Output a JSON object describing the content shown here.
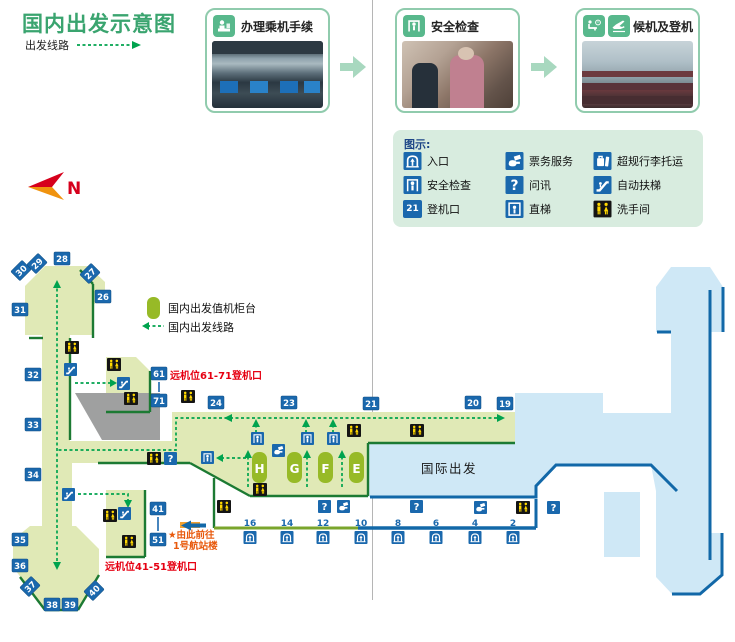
{
  "page": {
    "title": "国内出发示意图",
    "route_label": "出发线路"
  },
  "process_steps": [
    {
      "label": "办理乘机手续",
      "icon": "checkin-counter-icon"
    },
    {
      "label": "安全检查",
      "icon": "security-gate-icon"
    },
    {
      "label": "候机及登机",
      "icon": "waiting-and-plane-icon"
    }
  ],
  "legend": {
    "title": "图示:",
    "items": [
      {
        "icon": "entrance-icon",
        "label": "入口"
      },
      {
        "icon": "ticket-service-icon",
        "label": "票务服务"
      },
      {
        "icon": "oversize-baggage-icon",
        "label": "超规行李托运"
      },
      {
        "icon": "security-check-icon",
        "label": "安全检查"
      },
      {
        "icon": "information-icon",
        "label": "问讯"
      },
      {
        "icon": "escalator-icon",
        "label": "自动扶梯"
      },
      {
        "icon": "boarding-gate-icon",
        "label": "登机口",
        "badge": "21"
      },
      {
        "icon": "elevator-icon",
        "label": "直梯"
      },
      {
        "icon": "restroom-icon",
        "label": "洗手间"
      }
    ]
  },
  "compass": {
    "label": "N"
  },
  "map": {
    "legend": [
      {
        "type": "checkin-counter-swatch",
        "label": "国内出发值机柜台"
      },
      {
        "type": "route-dash-swatch",
        "label": "国内出发线路"
      }
    ],
    "international_label": "国际出发",
    "notes": [
      {
        "text": "远机位61-71登机口",
        "x": 170,
        "y": 379,
        "size": 10,
        "kind": "red"
      },
      {
        "text": "远机位41-51登机口",
        "x": 105,
        "y": 570,
        "size": 10,
        "kind": "red"
      },
      {
        "text": "★由此前往",
        "x": 168,
        "y": 538,
        "size": 9.5,
        "kind": "orange"
      },
      {
        "text": "1号航站楼",
        "x": 173,
        "y": 549,
        "size": 9.5,
        "kind": "orange"
      }
    ],
    "checkin_islands": [
      {
        "label": "H",
        "x": 252,
        "y": 452
      },
      {
        "label": "G",
        "x": 287,
        "y": 452
      },
      {
        "label": "F",
        "x": 318,
        "y": 452
      },
      {
        "label": "E",
        "x": 349,
        "y": 452
      }
    ],
    "gates": [
      {
        "n": "28",
        "x": 54,
        "y": 252,
        "rot": 0
      },
      {
        "n": "29",
        "x": 29,
        "y": 257,
        "rot": -45
      },
      {
        "n": "30",
        "x": 13,
        "y": 264,
        "rot": -45
      },
      {
        "n": "27",
        "x": 82,
        "y": 267,
        "rot": -45
      },
      {
        "n": "26",
        "x": 95,
        "y": 290,
        "rot": 0
      },
      {
        "n": "31",
        "x": 12,
        "y": 303,
        "rot": 0
      },
      {
        "n": "32",
        "x": 25,
        "y": 368,
        "rot": 0
      },
      {
        "n": "33",
        "x": 25,
        "y": 418,
        "rot": 0
      },
      {
        "n": "34",
        "x": 25,
        "y": 468,
        "rot": 0
      },
      {
        "n": "35",
        "x": 12,
        "y": 533,
        "rot": 0
      },
      {
        "n": "36",
        "x": 12,
        "y": 559,
        "rot": 0
      },
      {
        "n": "37",
        "x": 22,
        "y": 580,
        "rot": -45
      },
      {
        "n": "38",
        "x": 44,
        "y": 598,
        "rot": 0
      },
      {
        "n": "39",
        "x": 62,
        "y": 598,
        "rot": 0
      },
      {
        "n": "40",
        "x": 86,
        "y": 584,
        "rot": -45
      },
      {
        "n": "24",
        "x": 208,
        "y": 396,
        "rot": 0
      },
      {
        "n": "23",
        "x": 281,
        "y": 396,
        "rot": 0
      },
      {
        "n": "21",
        "x": 363,
        "y": 397,
        "rot": 0
      },
      {
        "n": "20",
        "x": 465,
        "y": 396,
        "rot": 0
      },
      {
        "n": "19",
        "x": 497,
        "y": 397,
        "rot": 0
      },
      {
        "n": "61",
        "x": 151,
        "y": 367,
        "rot": 0
      },
      {
        "n": "71",
        "x": 151,
        "y": 394,
        "rot": 0
      },
      {
        "n": "41",
        "x": 150,
        "y": 502,
        "rot": 0
      },
      {
        "n": "51",
        "x": 150,
        "y": 533,
        "rot": 0
      }
    ],
    "entrances": [
      {
        "n": "16",
        "cx": 250
      },
      {
        "n": "14",
        "cx": 287
      },
      {
        "n": "12",
        "cx": 323
      },
      {
        "n": "10",
        "cx": 361
      },
      {
        "n": "8",
        "cx": 398
      },
      {
        "n": "6",
        "cx": 436
      },
      {
        "n": "4",
        "cx": 475
      },
      {
        "n": "2",
        "cx": 513
      }
    ],
    "icons": [
      {
        "t": "security",
        "x": 251,
        "y": 432
      },
      {
        "t": "security",
        "x": 301,
        "y": 432
      },
      {
        "t": "security",
        "x": 327,
        "y": 432
      },
      {
        "t": "security",
        "x": 201,
        "y": 451
      },
      {
        "t": "question",
        "x": 164,
        "y": 452
      },
      {
        "t": "question",
        "x": 318,
        "y": 500
      },
      {
        "t": "question",
        "x": 410,
        "y": 500
      },
      {
        "t": "question",
        "x": 547,
        "y": 501
      },
      {
        "t": "ticket",
        "x": 272,
        "y": 444
      },
      {
        "t": "ticket",
        "x": 337,
        "y": 500
      },
      {
        "t": "ticket",
        "x": 474,
        "y": 501
      },
      {
        "t": "restroom",
        "x": 65,
        "y": 341
      },
      {
        "t": "restroom",
        "x": 107,
        "y": 358
      },
      {
        "t": "restroom",
        "x": 124,
        "y": 392
      },
      {
        "t": "restroom",
        "x": 181,
        "y": 390
      },
      {
        "t": "restroom",
        "x": 147,
        "y": 452
      },
      {
        "t": "restroom",
        "x": 347,
        "y": 424
      },
      {
        "t": "restroom",
        "x": 410,
        "y": 424
      },
      {
        "t": "restroom",
        "x": 253,
        "y": 483
      },
      {
        "t": "restroom",
        "x": 217,
        "y": 500
      },
      {
        "t": "restroom",
        "x": 516,
        "y": 501
      },
      {
        "t": "restroom",
        "x": 103,
        "y": 509
      },
      {
        "t": "restroom",
        "x": 122,
        "y": 535
      },
      {
        "t": "escalator",
        "x": 64,
        "y": 363
      },
      {
        "t": "escalator",
        "x": 117,
        "y": 377
      },
      {
        "t": "escalator",
        "x": 62,
        "y": 488
      },
      {
        "t": "escalator",
        "x": 118,
        "y": 507
      }
    ],
    "colors": {
      "domestic_fill": "#e0e9b6",
      "island_green": "#97ba27",
      "dark_green": "#1c7a33",
      "route_green": "#00a34e",
      "international_fill": "#cfe8f6",
      "border_blue": "#1268a8",
      "icon_blue": "#1a68ad",
      "restroom_black": "#141414",
      "restroom_yellow": "#ffd800",
      "note_red": "#e60012",
      "note_orange": "#e8590c",
      "gray_block": "#9fa0a0",
      "title_green": "#3aa46f"
    }
  }
}
